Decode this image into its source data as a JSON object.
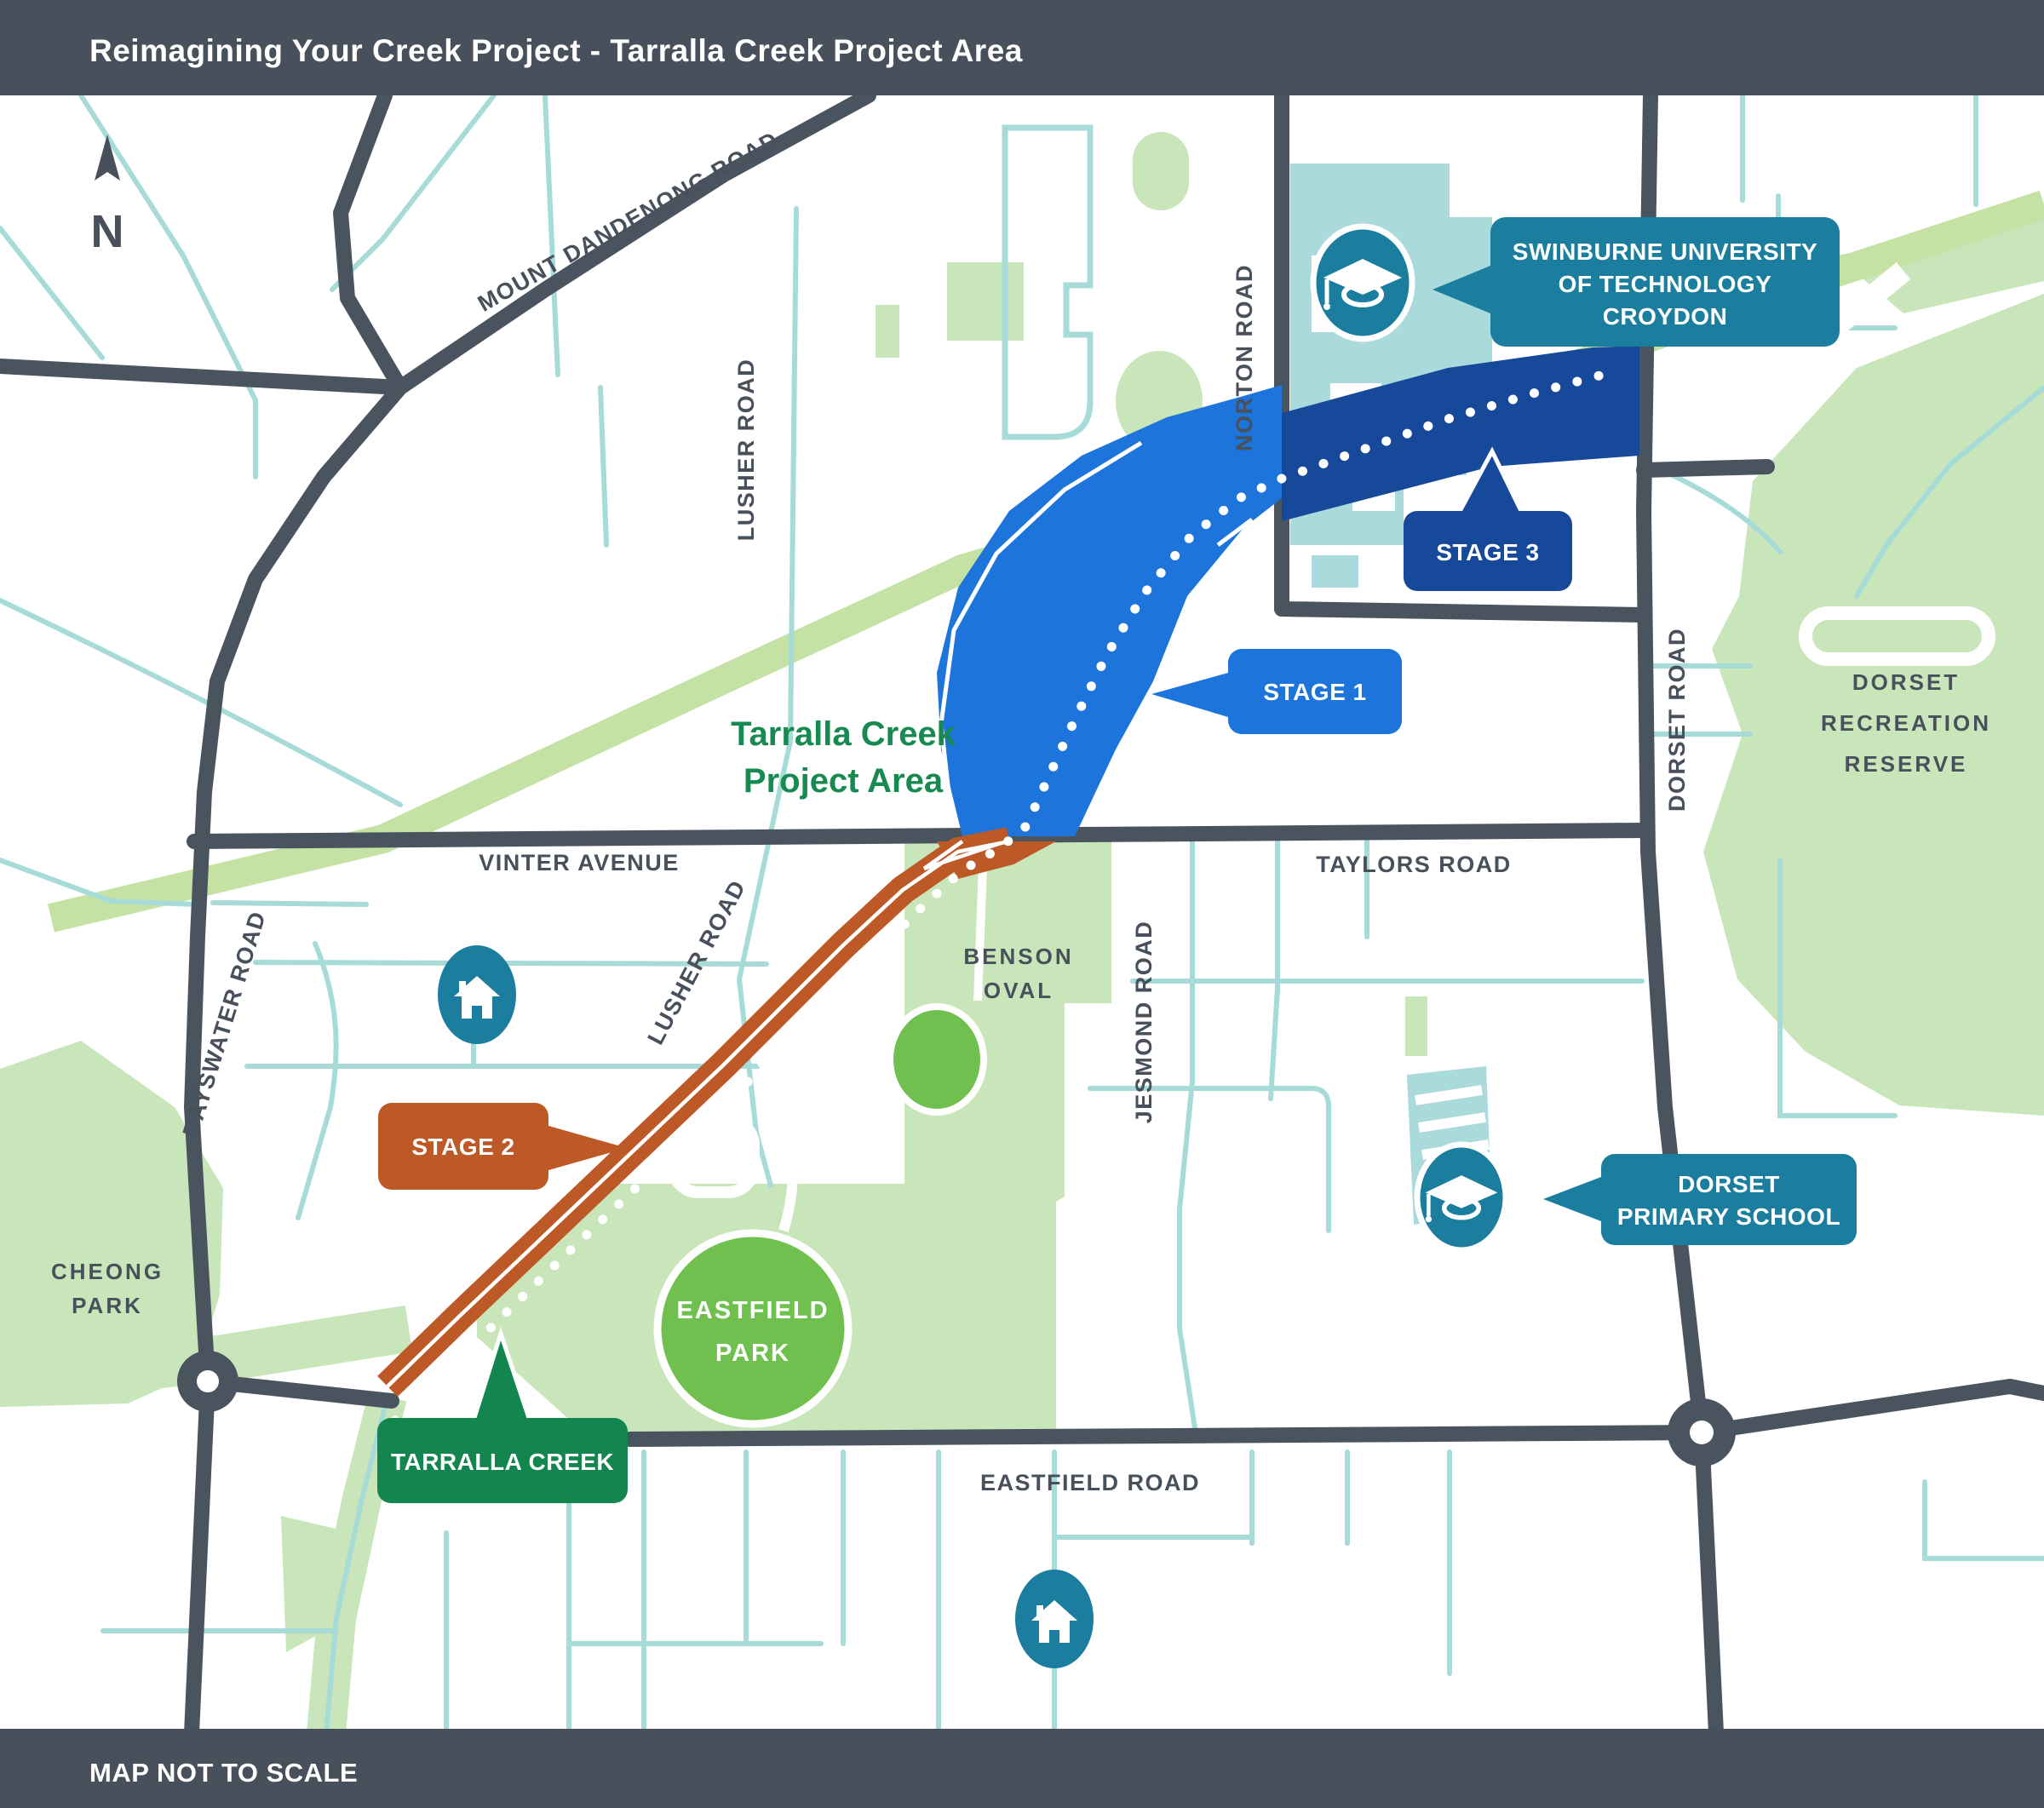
{
  "header": {
    "title": "Reimagining Your Creek Project - Tarralla Creek Project Area"
  },
  "footer": {
    "note": "MAP NOT TO SCALE"
  },
  "compass": {
    "label": "N"
  },
  "project_area_label": {
    "line1": "Tarralla Creek",
    "line2": "Project Area"
  },
  "roads": {
    "mount_dandenong": "MOUNT DANDENONG ROAD",
    "lusher_upper": "LUSHER ROAD",
    "lusher_lower": "LUSHER ROAD",
    "norton": "NORTON ROAD",
    "bayswater": "BAYSWATER ROAD",
    "vinter": "VINTER AVENUE",
    "taylors": "TAYLORS ROAD",
    "jesmond": "JESMOND ROAD",
    "dorset": "DORSET ROAD",
    "eastfield": "EASTFIELD ROAD"
  },
  "parks": {
    "cheong": {
      "line1": "CHEONG",
      "line2": "PARK"
    },
    "benson": {
      "line1": "BENSON",
      "line2": "OVAL"
    },
    "eastfield": {
      "line1": "EASTFIELD",
      "line2": "PARK"
    },
    "dorset_reserve": {
      "line1": "DORSET",
      "line2": "RECREATION",
      "line3": "RESERVE"
    }
  },
  "callouts": {
    "stage1": {
      "label": "STAGE 1",
      "color": "#1D74DB"
    },
    "stage2": {
      "label": "STAGE 2",
      "color": "#BD5827"
    },
    "stage3": {
      "label": "STAGE 3",
      "color": "#17499B"
    },
    "tarralla_creek": {
      "label": "TARRALLA CREEK",
      "color": "#13864F"
    },
    "swinburne": {
      "line1": "SWINBURNE UNIVERSITY",
      "line2": "OF TECHNOLOGY",
      "line3": "CROYDON",
      "color": "#1B7E9F"
    },
    "dorset_primary": {
      "line1": "DORSET",
      "line2": "PRIMARY SCHOOL",
      "color": "#1B7E9F"
    }
  },
  "icons": {
    "home": "home-icon",
    "graduation": "graduation-cap-icon",
    "north_arrow": "north-arrow-icon"
  },
  "colors": {
    "frame": "#47505B",
    "road": "#4A545F",
    "minor_road": "#A6DBD7",
    "park_green": "#C9E6BA",
    "corridor_green": "#C3E2A4",
    "oval_green": "#6FC04F",
    "stage1_blue": "#1D74DB",
    "stage3_navy": "#17499B",
    "stage2_orange": "#BD5827",
    "poi_teal": "#1B7E9F",
    "project_label_green": "#168A51",
    "campus_teal": "#ABDADC",
    "background": "#FFFFFF"
  }
}
